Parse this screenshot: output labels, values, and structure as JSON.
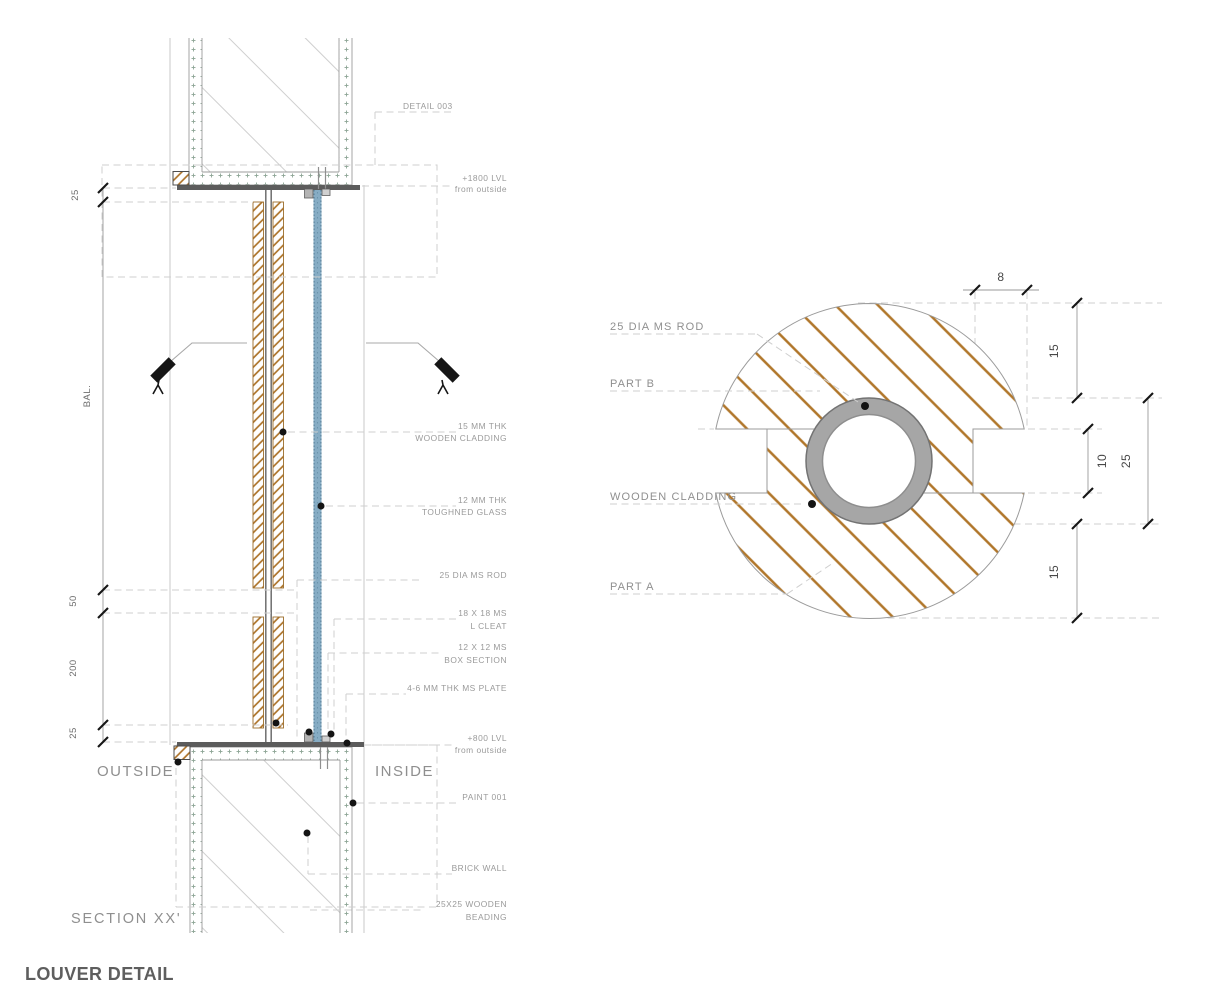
{
  "title": "LOUVER DETAIL",
  "section": {
    "name": "SECTION XX'",
    "outside": "OUTSIDE",
    "inside": "INSIDE",
    "dims": {
      "top25": "25",
      "bal": "BAL.",
      "gap50": "50",
      "louver200": "200",
      "bottom25": "25"
    },
    "callouts": {
      "detail_ref": "DETAIL 003",
      "level_top_line1": "+1800 LVL",
      "level_top_line2": "from outside",
      "cladding_line1": "15 MM THK",
      "cladding_line2": "WOODEN CLADDING",
      "glass_line1": "12 MM THK",
      "glass_line2": "TOUGHNED GLASS",
      "rod": "25 DIA MS ROD",
      "cleat_line1": "18 X 18 MS",
      "cleat_line2": "L CLEAT",
      "box_line1": "12 X 12 MS",
      "box_line2": "BOX SECTION",
      "plate": "4-6 MM THK MS PLATE",
      "level_bottom_line1": "+800 LVL",
      "level_bottom_line2": "from outside",
      "paint": "PAINT 001",
      "brick": "BRICK WALL",
      "beading_line1": "25X25 WOODEN",
      "beading_line2": "BEADING"
    }
  },
  "detail": {
    "labels": {
      "rod": "25 DIA MS ROD",
      "part_b": "PART B",
      "cladding": "WOODEN CLADDING",
      "part_a": "PART A"
    },
    "dims": {
      "notch8": "8",
      "top15": "15",
      "slot10": "10",
      "overall25": "25",
      "bottom15": "15"
    }
  },
  "colors": {
    "wood_hatch": "#b0762a",
    "glass": "#86acc4",
    "steel_plate": "#5c5c5c",
    "rod_ring": "#a6a6a6",
    "plaster_dot": "#8da595",
    "label_text": "#9a9a9a",
    "dim_text": "#474747"
  }
}
